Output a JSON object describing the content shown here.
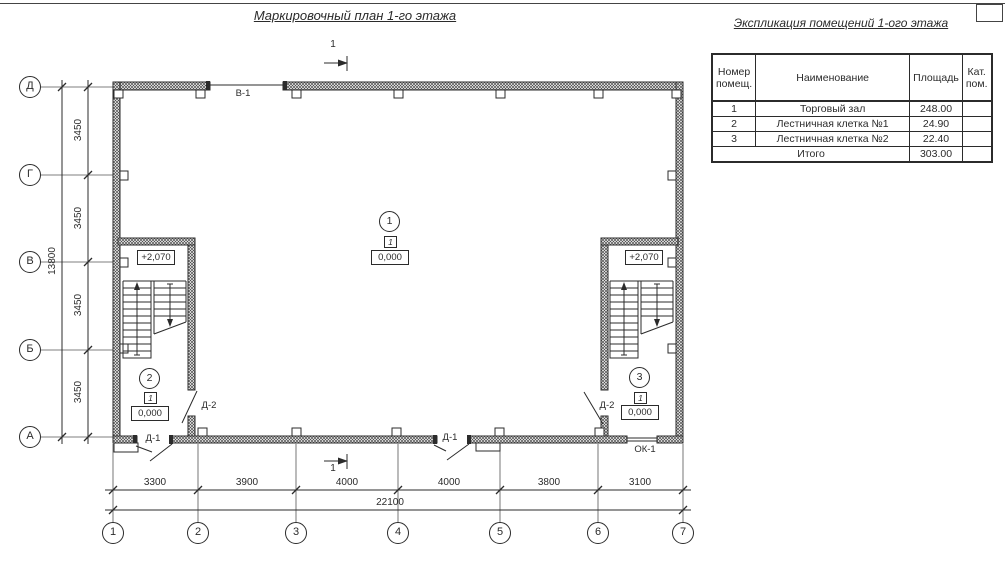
{
  "titles": {
    "main": "Маркировочный план 1-го этажа",
    "table": "Экспликация помещений 1-ого этажа"
  },
  "table": {
    "headers": {
      "num": "Номер помещ.",
      "name": "Наименование",
      "area": "Площадь",
      "cat": "Кат. пом."
    },
    "rows": [
      {
        "num": "1",
        "name": "Торговый зал",
        "area": "248.00",
        "cat": ""
      },
      {
        "num": "2",
        "name": "Лестничная клетка №1",
        "area": "24.90",
        "cat": ""
      },
      {
        "num": "3",
        "name": "Лестничная клетка №2",
        "area": "22.40",
        "cat": ""
      }
    ],
    "total_label": "Итого",
    "total_area": "303.00"
  },
  "axes": {
    "rows": [
      "Д",
      "Г",
      "В",
      "Б",
      "А"
    ],
    "cols": [
      "1",
      "2",
      "3",
      "4",
      "5",
      "6",
      "7"
    ]
  },
  "dims": {
    "left_segments": [
      "3450",
      "3450",
      "3450",
      "3450"
    ],
    "left_total": "13800",
    "bottom_segments": [
      "3300",
      "3900",
      "4000",
      "4000",
      "3800",
      "3100"
    ],
    "bottom_total": "22100"
  },
  "plan": {
    "section_label": "1",
    "labels": {
      "window_top": "В-1",
      "window_bottom": "ОК-1",
      "door_entry": "Д-1",
      "door_stair": "Д-2"
    },
    "rooms": [
      {
        "number": "1",
        "tag": "1",
        "elevation": "0,000"
      },
      {
        "number": "2",
        "tag": "1",
        "elevation": "0,000",
        "upper_elevation": "+2,070"
      },
      {
        "number": "3",
        "tag": "1",
        "elevation": "0,000",
        "upper_elevation": "+2,070"
      }
    ]
  },
  "colors": {
    "ink": "#2b2b2b",
    "background": "#ffffff"
  }
}
